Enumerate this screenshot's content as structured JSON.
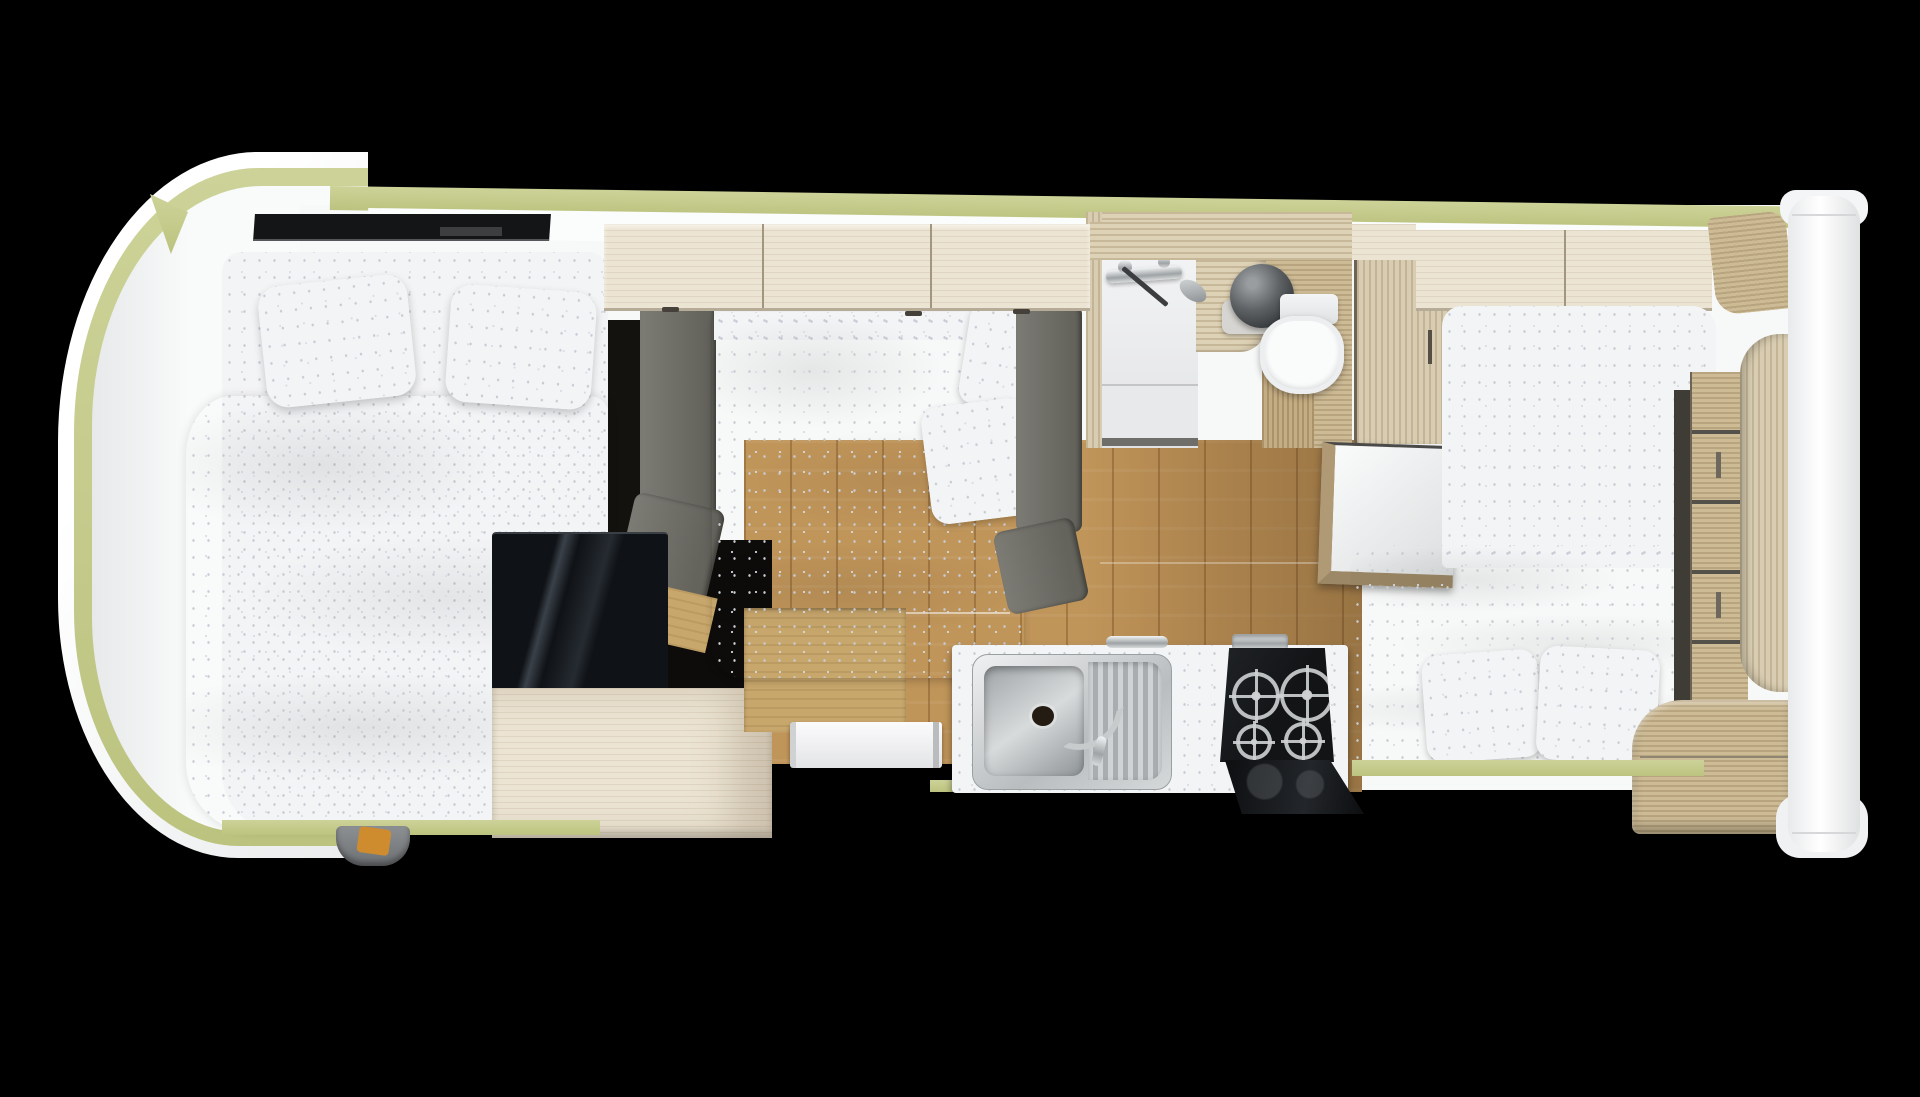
{
  "scene": {
    "title": "Motorhome interior floor plan — top-down 3D render",
    "view": "aerial top-down cutaway",
    "background_color": "#000000"
  },
  "vehicle": {
    "type": "motorhome / campervan",
    "body_color": "#f7f8f8",
    "trim_color": "#c4ca8d",
    "orientation": "cab at left, rear panel at right"
  },
  "furniture": {
    "skylight": {
      "label": "Cab roof skylight"
    },
    "front_bed": {
      "label": "Over-cab double bed",
      "pillow_count": 2,
      "bedding": "white speckled duvet"
    },
    "front_bench": {
      "label": "Grey upholstered backrest"
    },
    "glass_cabinet": {
      "label": "Dark glass-top cabinet"
    },
    "side_cabinet": {
      "label": "Pale wood side cabinet"
    },
    "mid_bed": {
      "label": "Centre double bed",
      "pillow_count": 2,
      "bedding": "white speckled duvet"
    },
    "sofa_back": {
      "label": "Grey sofa backrest"
    },
    "overhead_lockers_front": {
      "label": "Overhead lockers (front)",
      "door_count": 3
    },
    "overhead_lockers_rear": {
      "label": "Overhead lockers (rear)",
      "door_count": 2
    },
    "washroom": {
      "label": "Washroom",
      "fixtures": [
        "wall mixer and hand shower",
        "round dark washbasin",
        "toilet",
        "wood vanity",
        "sliding door"
      ]
    },
    "wardrobe": {
      "label": "Wardrobe unit"
    },
    "table": {
      "label": "Wall-mounted side table"
    },
    "kitchen": {
      "label": "Kitchen",
      "fixtures": [
        "stainless sink with drainer",
        "chrome tap",
        "gas hob",
        "folded glass hob lid",
        "towel rail"
      ],
      "burner_count": 4
    },
    "entry_step": {
      "label": "Entrance door step"
    },
    "rear_bed": {
      "label": "Rear double bed",
      "pillow_count": 2,
      "bedding": "white speckled duvet"
    },
    "rear_drawers": {
      "label": "Chest of drawers",
      "drawer_count": 5
    },
    "rear_corner_cabinet": {
      "label": "Curved corner cabinet"
    },
    "rear_bottom_cabinet": {
      "label": "Rear corner base cabinet"
    },
    "rear_panel": {
      "label": "White rear body panel"
    },
    "floor": {
      "label": "Oak-effect corridor floor"
    },
    "seatbelt": {
      "label": "Cab seat-belt buckle"
    }
  },
  "palette": {
    "background": "#000000",
    "body_white": "#f7f8f8",
    "trim_olive": "#c4ca8d",
    "wood_pale": "#ece4d3",
    "wood_streak": "#ded2b6",
    "wood_deck": "#cdbb96",
    "floor_oak": "#c0955a",
    "upholstery_grey": "#73726b",
    "bedding_white": "#f4f5f7",
    "steel": "#c9cccd",
    "hob_black": "#17191b",
    "basin_dark": "#3f4244"
  }
}
